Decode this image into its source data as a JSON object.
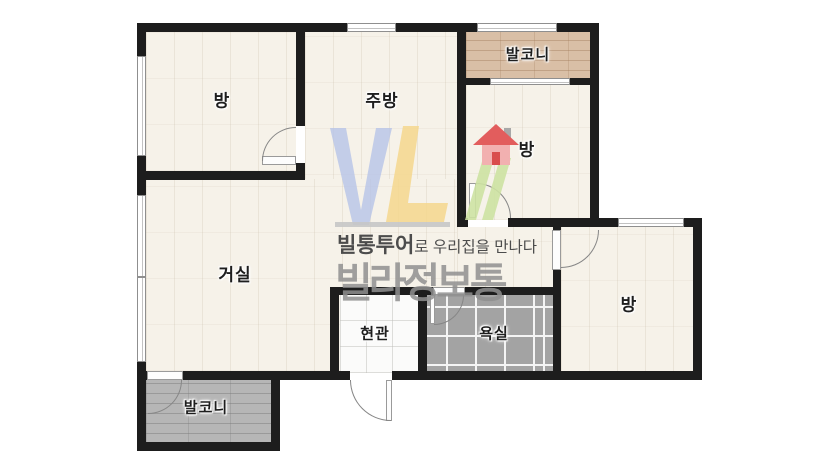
{
  "plan": {
    "title": "apartment-floor-plan",
    "rooms": {
      "bedroom_top_left": "방",
      "kitchen": "주방",
      "balcony_top": "발코니",
      "bedroom_top_right": "방",
      "living_room": "거실",
      "entrance": "현관",
      "bathroom": "욕실",
      "bedroom_bottom_right": "방",
      "balcony_bottom": "발코니"
    }
  },
  "watermark": {
    "tagline_brand": "빌통투어",
    "tagline_rest": "로 우리집을 만나다",
    "brand": "빌라정보통"
  },
  "colors": {
    "wall": "#1d1d1d",
    "floor": "#f6f2e9",
    "balcony_top_planks": "#d9bfa6",
    "balcony_bottom_planks": "#b6b6b6",
    "bathroom_tile": "#a3a3a3",
    "entrance_tile": "#fbfbfa",
    "logo_blue": "#b7c3e7",
    "logo_yellow": "#f4d78d",
    "logo_green": "#cde2a2",
    "logo_roof_red": "#e25d5d",
    "logo_body_pink": "#f2b0b0",
    "brand_text_gray": "#909090"
  }
}
